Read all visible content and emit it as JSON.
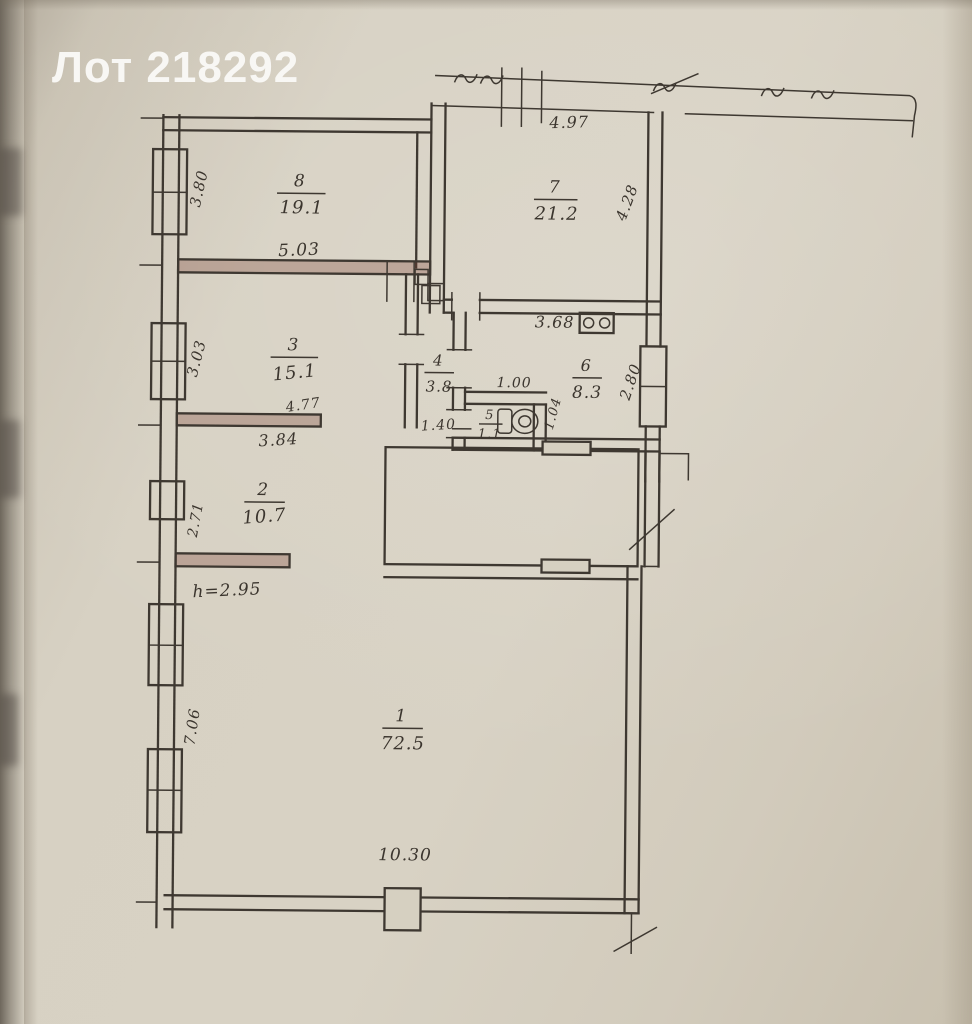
{
  "page": {
    "title": "Лот 218292"
  },
  "colors": {
    "paper": "#d6cfbf",
    "ink": "#3e3831",
    "wall_marked": "#763c2e",
    "title_text": "#f8f7f4"
  },
  "icons": {
    "wc": "toilet-icon",
    "kitchen": "stove-icon"
  },
  "plan": {
    "rooms": {
      "r1": {
        "number": "1",
        "area": "72.5"
      },
      "r2": {
        "number": "2",
        "area": "10.7"
      },
      "r3": {
        "number": "3",
        "area": "15.1"
      },
      "r4": {
        "number": "4",
        "area": "3.8"
      },
      "r5": {
        "number": "5",
        "area": "1.1"
      },
      "r6": {
        "number": "6",
        "area": "8.3"
      },
      "r7": {
        "number": "7",
        "area": "21.2"
      },
      "r8": {
        "number": "8",
        "area": "19.1"
      }
    },
    "dims": {
      "room7_top": "4.97",
      "room7_right": "4.28",
      "room8_left": "3.80",
      "room8_bottom": "5.03",
      "room3_left": "3.03",
      "room3_width_top": "4.77",
      "room3_width_bottom": "3.84",
      "room6_top": "3.68",
      "room6_right": "2.80",
      "wc_width": "1.00",
      "wc_door": "1.40",
      "wc_right": "1.04",
      "room2_left": "2.71",
      "ceiling_height": "h=2.95",
      "room1_left": "7.06",
      "room1_bottom": "10.30"
    }
  }
}
